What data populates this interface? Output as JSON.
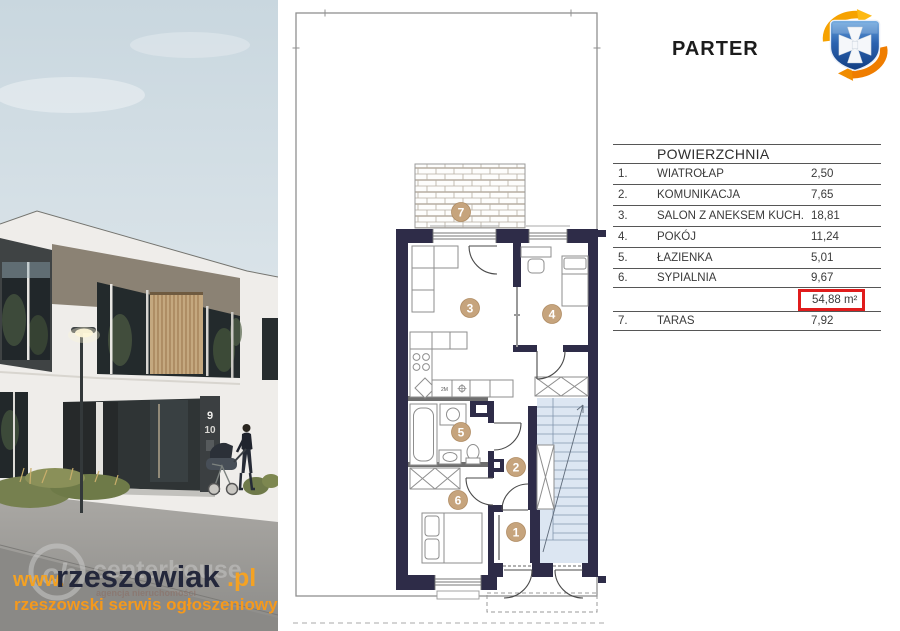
{
  "title": "PARTER",
  "logo": {
    "name": "rzeszowiak-crest-logo",
    "shield_color": "#1f4f9e",
    "swirl_color_top": "#f6a200",
    "swirl_color_bottom": "#ef7d00"
  },
  "photo": {
    "house_numbers": {
      "upper": "9",
      "lower": "10"
    },
    "watermark": {
      "www": "www.",
      "name": "rzeszowiak",
      "tld": ".pl",
      "tagline": "rzeszowski serwis ogłoszeniowy",
      "ghost_initials": "ch",
      "ghost_name": "centerhouse",
      "ghost_sub": "agencja nieruchomości",
      "orange": "#f5a01d",
      "dark": "#23273b"
    }
  },
  "floorplan": {
    "badges": [
      "1",
      "2",
      "3",
      "4",
      "5",
      "6",
      "7"
    ],
    "kitchen_note": "2M",
    "wall_color": "#2e2c48",
    "stairs_color": "#dce6f2",
    "badge_color": "#c6a47d"
  },
  "area_table": {
    "header": "POWIERZCHNIA",
    "rows": [
      {
        "num": "1.",
        "label": "WIATROŁAP",
        "value": "2,50"
      },
      {
        "num": "2.",
        "label": "KOMUNIKACJA",
        "value": "7,65"
      },
      {
        "num": "3.",
        "label": "SALON Z ANEKSEM KUCH.",
        "value": "18,81"
      },
      {
        "num": "4.",
        "label": "POKÓJ",
        "value": "11,24"
      },
      {
        "num": "5.",
        "label": "ŁAZIENKA",
        "value": "5,01"
      },
      {
        "num": "6.",
        "label": "SYPIALNIA",
        "value": "9,67"
      }
    ],
    "total": {
      "value": "54,88 m²"
    },
    "terrace": {
      "num": "7.",
      "label": "TARAS",
      "value": "7,92"
    },
    "highlight_color": "#e01c1c"
  }
}
